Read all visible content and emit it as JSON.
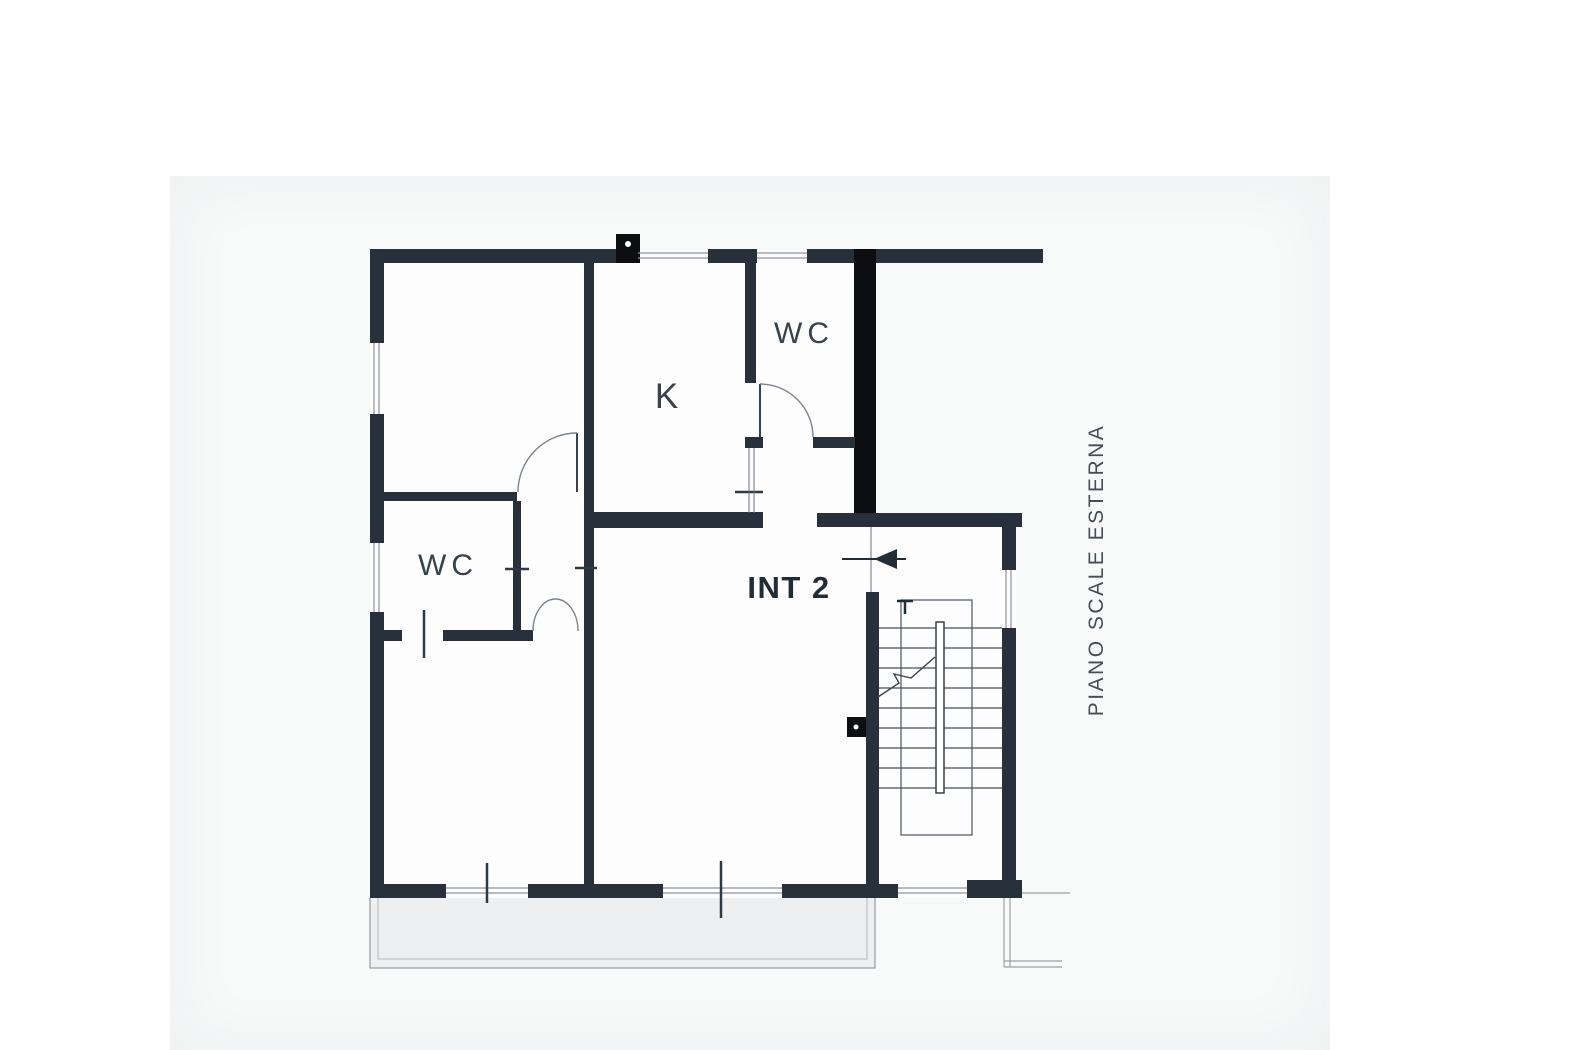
{
  "document": {
    "type": "floor-plan",
    "unit_label": "INT 2"
  },
  "labels": {
    "wc_top": "WC",
    "kitchen": "K",
    "wc_left": "WC",
    "unit": "INT 2",
    "side_note": "PIANO SCALE ESTERNA"
  },
  "colors": {
    "wall": "#28313b",
    "column": "#0c0e11",
    "window_line": "#8d959d",
    "door_line": "#7b848d",
    "stair_line": "#454f59",
    "landing_line": "#9aa2a8",
    "text": "#39424b",
    "text_bold": "#222c35",
    "balcony_fill": "#edeff0",
    "scan_background": "#f8f9f9",
    "page_background": "#ffffff"
  }
}
